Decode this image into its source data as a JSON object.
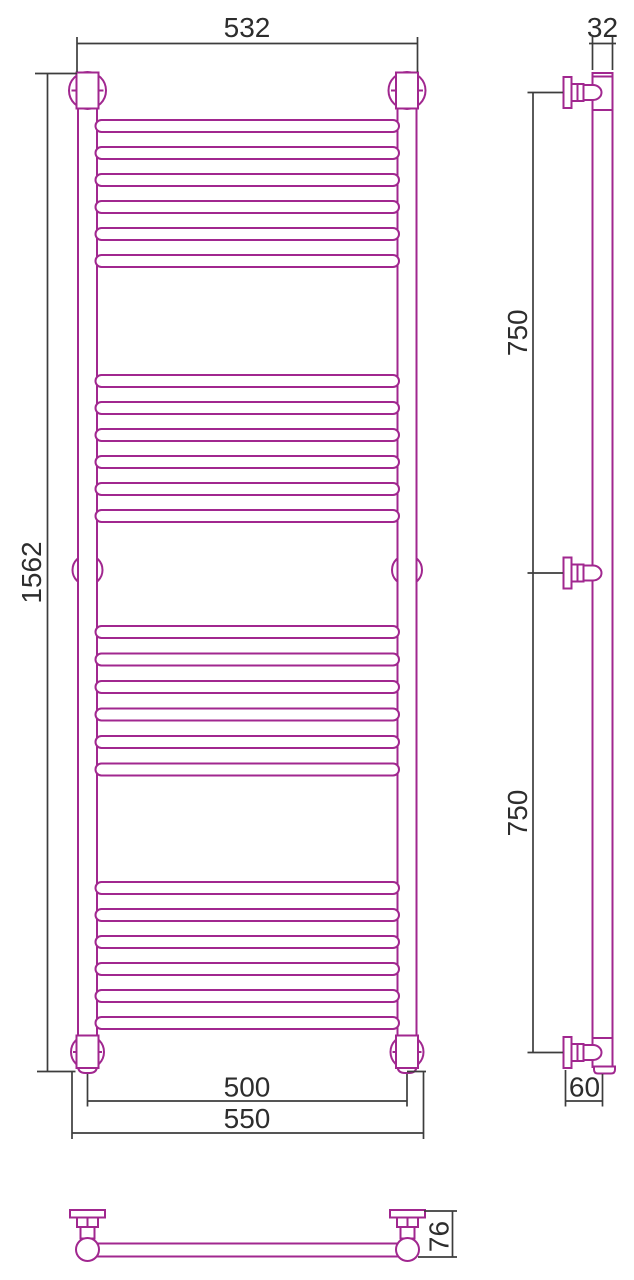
{
  "drawing": {
    "title": "ladder towel rail technical drawing, three orthographic views",
    "colors": {
      "product_outline": "#A1278F",
      "dimension_lines": "#3D3D3D",
      "label_text": "#2D2D2D",
      "background": "#FFFFFF"
    },
    "front_view": {
      "labels": {
        "top_width": "532",
        "height": "1562",
        "bottom_inner_width": "500",
        "bottom_outer_width": "550"
      },
      "post_centers_x": [
        87.5,
        407
      ],
      "mid_bracket_y": 570,
      "rung_tops": [
        120,
        147,
        174,
        201,
        228,
        255,
        375,
        402,
        429,
        456,
        483,
        510,
        626,
        653.5,
        681,
        708.5,
        736,
        763.5,
        882,
        909,
        936,
        963,
        990,
        1017
      ]
    },
    "side_view": {
      "labels": {
        "tube_diameter": "32",
        "upper_spacing": "750",
        "lower_spacing": "750",
        "wall_distance": "60"
      },
      "bracket_centers_y": [
        92.5,
        573,
        1052.5
      ]
    },
    "top_view": {
      "labels": {
        "depth": "76"
      },
      "bracket_centers_x": [
        87.5,
        407.5
      ]
    }
  }
}
